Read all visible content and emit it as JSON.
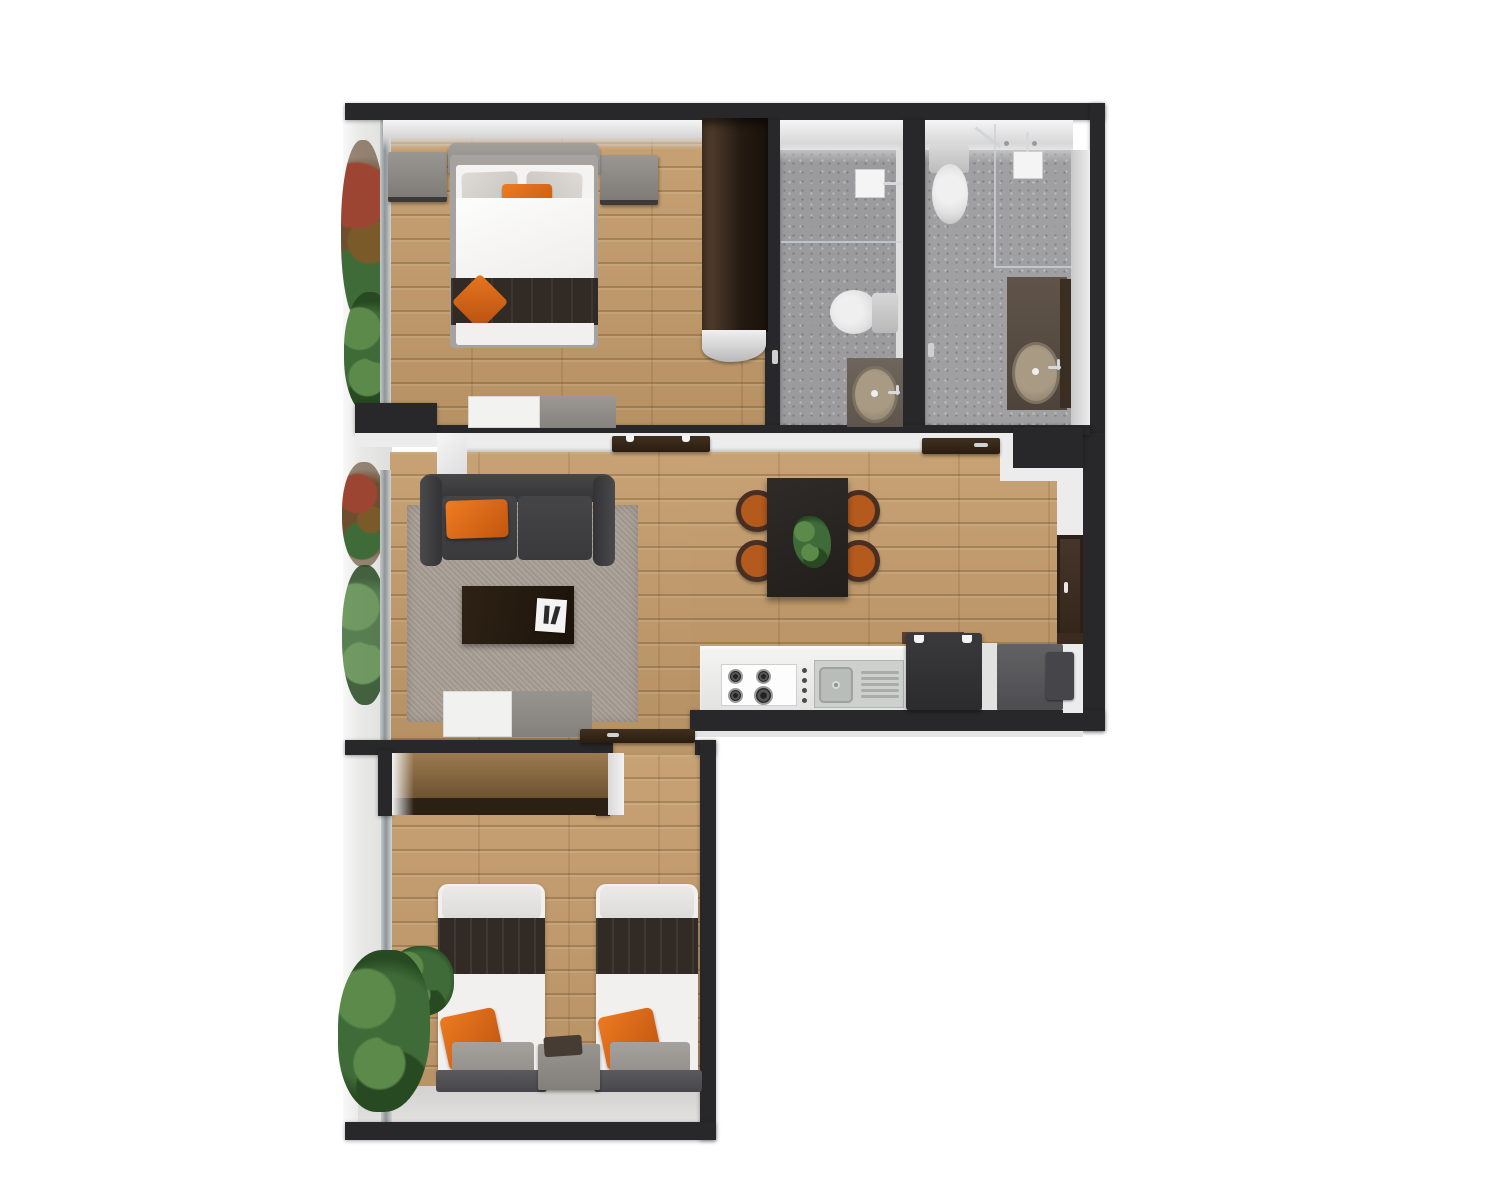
{
  "scene": {
    "type": "top-down 3D apartment floor plan render",
    "view": "orthographic overhead",
    "rooms": [
      {
        "name": "master-bedroom",
        "position": "top-left",
        "furniture": [
          "double-bed",
          "gray-pillows",
          "orange-accent-pillow",
          "dark-foot-runner",
          "orange-diamond-pillow",
          "nightstand-left",
          "nightstand-right",
          "dresser",
          "open-wardrobe",
          "balcony-window"
        ]
      },
      {
        "name": "bathroom-1",
        "position": "top-middle-right",
        "fixtures": [
          "rain-shower-head",
          "glass-partition",
          "toilet",
          "vanity-counter",
          "oval-sink",
          "chrome-tap"
        ]
      },
      {
        "name": "bathroom-2",
        "position": "top-right",
        "fixtures": [
          "toilet",
          "rain-shower-head",
          "glass-enclosure",
          "vanity-counter",
          "oval-sink",
          "chrome-tap"
        ]
      },
      {
        "name": "living-dining-room",
        "position": "middle",
        "furniture": [
          "two-seat-sofa",
          "orange-sofa-pillow",
          "area-rug",
          "coffee-table",
          "magazine",
          "tv-stand",
          "dining-table",
          "table-plant",
          "dining-chair x4",
          "entry-door",
          "open-door-leaf x3"
        ]
      },
      {
        "name": "kitchen",
        "position": "middle-bottom-right",
        "fixtures": [
          "white-counter",
          "gas-hob-4-burner",
          "control-knobs",
          "stainless-sink",
          "drainer",
          "dishwasher",
          "refrigerator"
        ]
      },
      {
        "name": "twin-bedroom",
        "position": "bottom-left",
        "furniture": [
          "single-bed-left",
          "single-bed-right",
          "dark-bed-runner x2",
          "orange-pillow x2",
          "gray-cushion x2",
          "shared-nightstand",
          "storage-niche",
          "indoor-plants",
          "balcony-window"
        ]
      },
      {
        "name": "balcony",
        "position": "left-strip",
        "items": [
          "autumn-plant",
          "monstera-plant",
          "red-plant",
          "shrub-plants",
          "glazed-doors"
        ]
      }
    ]
  },
  "palette": {
    "page_bg": "#ffffff",
    "wall": "#28282a",
    "wall_face": "#ececed",
    "wood": "#c49c6b",
    "bath_floor": "#9b9b9e",
    "rug": "#a89e95",
    "sofa_dark": "#3a3a3c",
    "accent_orange": "#d4671c",
    "chair_orange": "#b55a1d",
    "furn_gray": "#8d8a86",
    "espresso": "#241a11",
    "dark_wood": "#2c2015",
    "white_furn": "#f1f0ee",
    "counter_white": "#eaeae9",
    "appliance_dark": "#323234",
    "appliance_gray": "#58585b",
    "sink_beige": "#a89a83",
    "plant_green": "#3f6b38",
    "plant_light": "#5b8a4a",
    "plant_dark": "#274a22",
    "plant_red": "#9c4533",
    "porcelain": "#e2e2e2"
  }
}
